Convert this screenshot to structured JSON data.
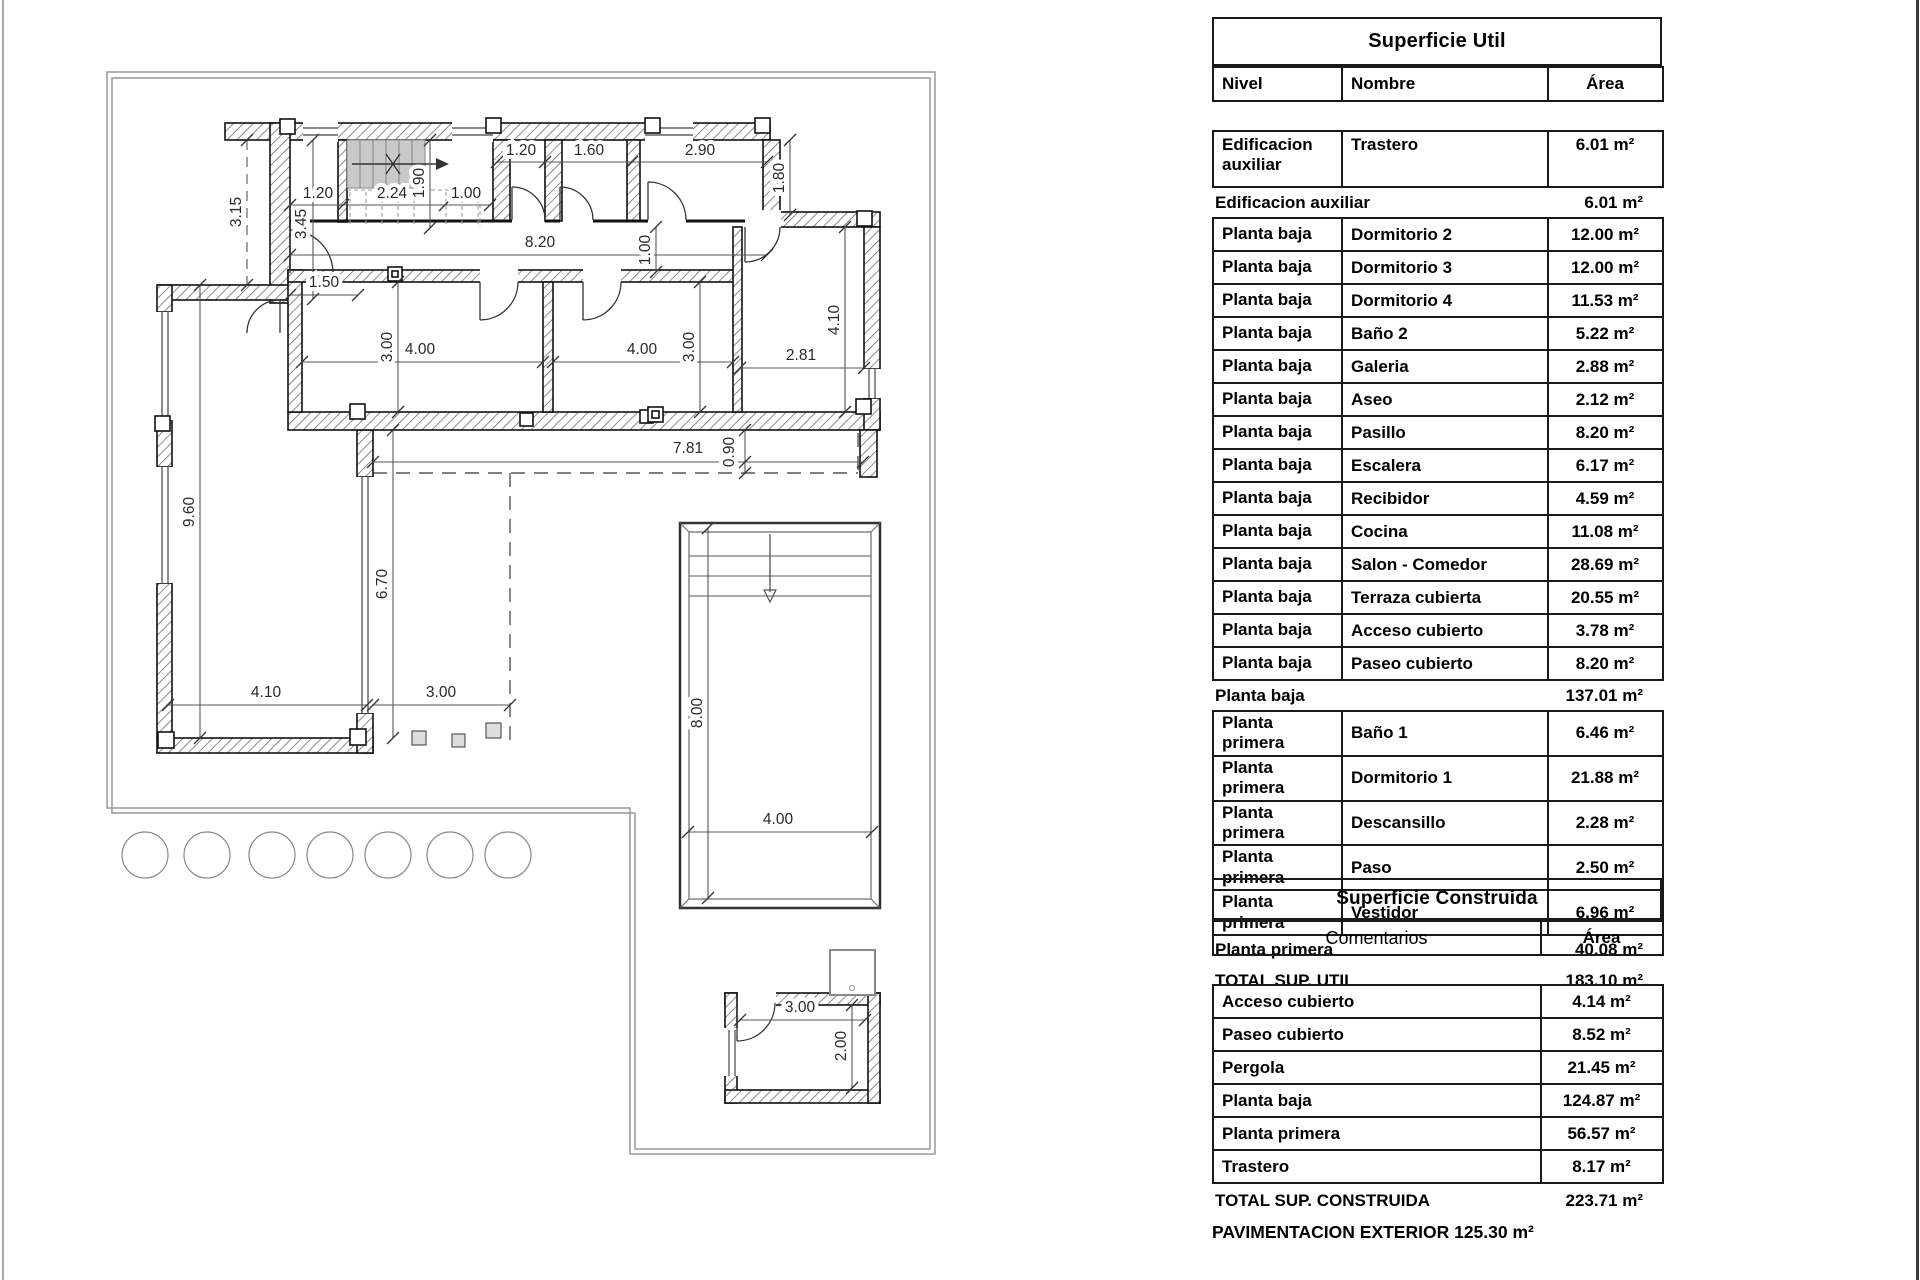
{
  "floor_plan": {
    "dim_labels": [
      {
        "t": "3.15",
        "x": 241,
        "y": 212,
        "v": true
      },
      {
        "t": "1.20",
        "x": 318,
        "y": 198
      },
      {
        "t": "2.24",
        "x": 392,
        "y": 198
      },
      {
        "t": "1.00",
        "x": 466,
        "y": 198
      },
      {
        "t": "1.90",
        "x": 424,
        "y": 183,
        "v": true
      },
      {
        "t": "3.45",
        "x": 306,
        "y": 224,
        "v": true
      },
      {
        "t": "1.20",
        "x": 521,
        "y": 155
      },
      {
        "t": "1.60",
        "x": 589,
        "y": 155
      },
      {
        "t": "2.90",
        "x": 700,
        "y": 155
      },
      {
        "t": "1.80",
        "x": 784,
        "y": 178,
        "v": true
      },
      {
        "t": "8.20",
        "x": 540,
        "y": 247
      },
      {
        "t": "1.00",
        "x": 650,
        "y": 250,
        "v": true
      },
      {
        "t": "1.50",
        "x": 324,
        "y": 287
      },
      {
        "t": "4.00",
        "x": 420,
        "y": 354
      },
      {
        "t": "3.00",
        "x": 392,
        "y": 347,
        "v": true
      },
      {
        "t": "4.00",
        "x": 642,
        "y": 354
      },
      {
        "t": "3.00",
        "x": 694,
        "y": 347,
        "v": true
      },
      {
        "t": "2.81",
        "x": 801,
        "y": 360
      },
      {
        "t": "4.10",
        "x": 839,
        "y": 320,
        "v": true
      },
      {
        "t": "7.81",
        "x": 688,
        "y": 453
      },
      {
        "t": "0.90",
        "x": 734,
        "y": 452,
        "v": true
      },
      {
        "t": "9.60",
        "x": 194,
        "y": 512,
        "v": true
      },
      {
        "t": "6.70",
        "x": 387,
        "y": 584,
        "v": true
      },
      {
        "t": "4.10",
        "x": 266,
        "y": 697
      },
      {
        "t": "3.00",
        "x": 441,
        "y": 697
      },
      {
        "t": "8.00",
        "x": 702,
        "y": 713,
        "v": true
      },
      {
        "t": "4.00",
        "x": 778,
        "y": 824
      },
      {
        "t": "3.00",
        "x": 800,
        "y": 1012
      },
      {
        "t": "2.00",
        "x": 846,
        "y": 1046,
        "v": true
      }
    ]
  },
  "tables": {
    "superficie_util": {
      "title": "Superficie Util",
      "columns": [
        "Nivel",
        "Nombre",
        "Área"
      ],
      "rows": [
        {
          "type": "data",
          "nivel": "Edificacion auxiliar",
          "nombre": "Trastero",
          "area": "6.01 m²",
          "tall": true
        },
        {
          "type": "subtotal",
          "label": "Edificacion auxiliar",
          "area": "6.01 m²"
        },
        {
          "type": "data",
          "nivel": "Planta baja",
          "nombre": "Dormitorio 2",
          "area": "12.00 m²"
        },
        {
          "type": "data",
          "nivel": "Planta baja",
          "nombre": "Dormitorio 3",
          "area": "12.00 m²"
        },
        {
          "type": "data",
          "nivel": "Planta baja",
          "nombre": "Dormitorio 4",
          "area": "11.53 m²"
        },
        {
          "type": "data",
          "nivel": "Planta baja",
          "nombre": "Baño 2",
          "area": "5.22 m²"
        },
        {
          "type": "data",
          "nivel": "Planta baja",
          "nombre": "Galeria",
          "area": "2.88 m²"
        },
        {
          "type": "data",
          "nivel": "Planta baja",
          "nombre": "Aseo",
          "area": "2.12 m²"
        },
        {
          "type": "data",
          "nivel": "Planta baja",
          "nombre": "Pasillo",
          "area": "8.20 m²"
        },
        {
          "type": "data",
          "nivel": "Planta baja",
          "nombre": "Escalera",
          "area": "6.17 m²"
        },
        {
          "type": "data",
          "nivel": "Planta baja",
          "nombre": "Recibidor",
          "area": "4.59 m²"
        },
        {
          "type": "data",
          "nivel": "Planta baja",
          "nombre": "Cocina",
          "area": "11.08 m²"
        },
        {
          "type": "data",
          "nivel": "Planta baja",
          "nombre": "Salon - Comedor",
          "area": "28.69 m²"
        },
        {
          "type": "data",
          "nivel": "Planta baja",
          "nombre": "Terraza cubierta",
          "area": "20.55 m²"
        },
        {
          "type": "data",
          "nivel": "Planta baja",
          "nombre": "Acceso cubierto",
          "area": "3.78 m²"
        },
        {
          "type": "data",
          "nivel": "Planta baja",
          "nombre": "Paseo cubierto",
          "area": "8.20 m²"
        },
        {
          "type": "subtotal",
          "label": "Planta baja",
          "area": "137.01 m²"
        },
        {
          "type": "data",
          "nivel": "Planta primera",
          "nombre": "Baño 1",
          "area": "6.46 m²"
        },
        {
          "type": "data",
          "nivel": "Planta primera",
          "nombre": "Dormitorio 1",
          "area": "21.88 m²"
        },
        {
          "type": "data",
          "nivel": "Planta primera",
          "nombre": "Descansillo",
          "area": "2.28 m²"
        },
        {
          "type": "data",
          "nivel": "Planta primera",
          "nombre": "Paso",
          "area": "2.50 m²"
        },
        {
          "type": "data",
          "nivel": "Planta primera",
          "nombre": "Vestidor",
          "area": "6.96 m²"
        },
        {
          "type": "subtotal",
          "label": "Planta primera",
          "area": "40.08 m²"
        },
        {
          "type": "total",
          "label": "TOTAL SUP. UTIL",
          "area": "183.10 m²"
        }
      ]
    },
    "superficie_construida": {
      "title": "Superficie Construida",
      "columns": [
        "Comentarios",
        "Área"
      ],
      "rows": [
        {
          "type": "data",
          "nombre": "Acceso cubierto",
          "area": "4.14 m²"
        },
        {
          "type": "data",
          "nombre": "Paseo cubierto",
          "area": "8.52 m²"
        },
        {
          "type": "data",
          "nombre": "Pergola",
          "area": "21.45 m²"
        },
        {
          "type": "data",
          "nombre": "Planta baja",
          "area": "124.87 m²"
        },
        {
          "type": "data",
          "nombre": "Planta primera",
          "area": "56.57 m²"
        },
        {
          "type": "data",
          "nombre": "Trastero",
          "area": "8.17 m²"
        },
        {
          "type": "total",
          "label": "TOTAL SUP. CONSTRUIDA",
          "area": "223.71 m²"
        }
      ]
    },
    "footer_note": "PAVIMENTACION EXTERIOR 125.30 m²"
  }
}
